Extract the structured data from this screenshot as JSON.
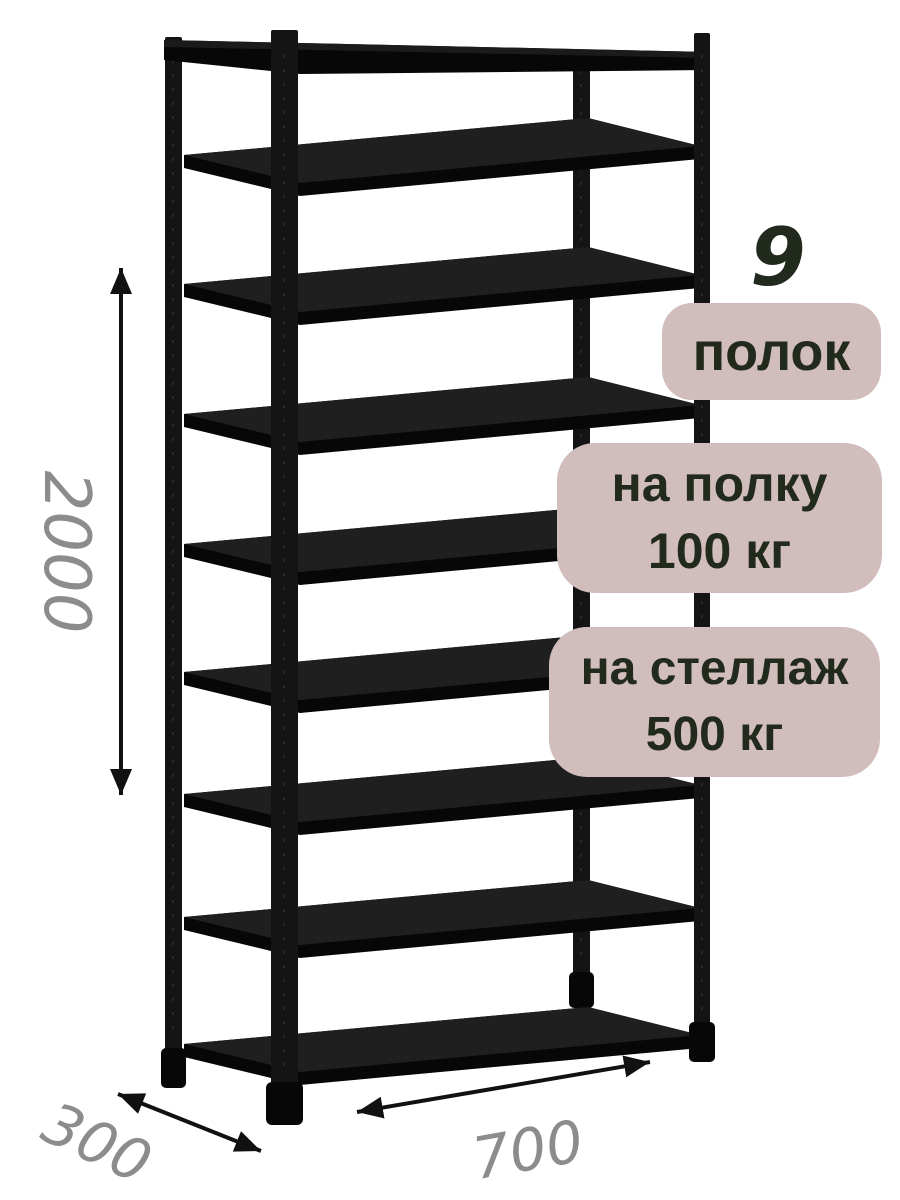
{
  "badges": {
    "shelf_count": {
      "number": "9",
      "label": "полок"
    },
    "shelf_load": {
      "line1": "на полку",
      "line2": "100 кг"
    },
    "rack_load": {
      "line1": "на стеллаж",
      "line2": "500 кг"
    }
  },
  "dimensions": {
    "height": "2000",
    "depth": "300",
    "width": "700"
  },
  "colors": {
    "badge_bg": "#d2bdbd",
    "badge_text": "#212a1d",
    "dimension_text": "#8c8c8c",
    "frame_black": "#141414",
    "shelf_top": "#1f1f1f",
    "shelf_edge": "#070707",
    "arrow_black": "#111111",
    "background": "#ffffff"
  }
}
